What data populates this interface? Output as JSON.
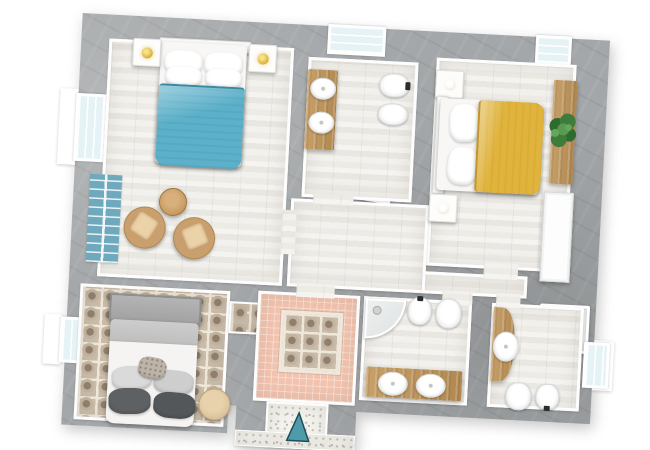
{
  "scene": {
    "type": "apartment-floor-plan-3d-top-view",
    "rotation_deg": 3,
    "visible_text": "none"
  },
  "colors": {
    "outside": "#ffffff",
    "wall": "#a4a7a9",
    "floor-plank": "#efede8",
    "plank-line": "#e9e7e1",
    "tile-pink": "#f2c3ae",
    "tile-cream": "#efe8da",
    "tile-rosette": "#8f7f6c",
    "speckle": "#f4f3ee",
    "speckle-dot": "#c6c2b7",
    "wood": "#c8a06a",
    "wood-dark": "#b08850",
    "teal-bed": "#5cb0c9",
    "yellow-bed": "#e0b33c",
    "gray-bed": "#b5b5b5",
    "window-glass": "#e6f3f6",
    "arrow-teal": "#4e9cab",
    "plant-green": "#3f7c3c",
    "lamp-gold": "#d9ae35",
    "rug-teal": "#6fa9bd",
    "rattan": "#c99f6d"
  },
  "rooms": [
    {
      "id": "bedroom-teal",
      "name": "bedroom with teal double bed and sitting area",
      "items": [
        "double-bed-teal",
        "nightstand-lamp-left",
        "nightstand-lamp-right",
        "teal-runner-rug",
        "round-wood-table",
        "wicker-chair-1",
        "wicker-chair-2"
      ]
    },
    {
      "id": "bathroom-top",
      "name": "bathroom with double-sink vanity, toilet, bidet and shower",
      "items": [
        "wood-vanity-two-sinks",
        "toilet",
        "bidet",
        "shower-tray"
      ]
    },
    {
      "id": "bedroom-yellow",
      "name": "bedroom with yellow double bed, plant console and wardrobe",
      "items": [
        "double-bed-yellow",
        "nightstand-lamp-top",
        "nightstand-lamp-bottom",
        "wood-console-with-plant",
        "white-wardrobe"
      ]
    },
    {
      "id": "hallway",
      "name": "central hallway with wood plank floor",
      "items": []
    },
    {
      "id": "bedroom-gray",
      "name": "bedroom with gray upholstered bed on decorative encaustic tile floor",
      "items": [
        "double-bed-gray",
        "decorative-pillows",
        "round-pouf"
      ]
    },
    {
      "id": "hall-pink",
      "name": "pink tiled hall with decorative tile inset",
      "items": [
        "decorative-tile-inset"
      ]
    },
    {
      "id": "entry",
      "name": "entrance with terrazzo floor and direction arrow",
      "items": [
        "entrance-arrow"
      ]
    },
    {
      "id": "bathroom-left",
      "name": "bathroom with corner shower, bidet, toilet and double-sink vanity",
      "items": [
        "corner-shower",
        "bidet",
        "toilet",
        "wood-vanity-two-sinks"
      ]
    },
    {
      "id": "bathroom-right",
      "name": "bathroom with curved vanity, shower, toilet and bidet",
      "items": [
        "curved-wood-vanity-sink",
        "shower-tray",
        "toilet",
        "bidet"
      ]
    }
  ],
  "windows": [
    {
      "id": "window-top-bathroom"
    },
    {
      "id": "window-top-bedroom-yellow"
    },
    {
      "id": "window-left-bedroom-teal"
    },
    {
      "id": "window-left-bedroom-gray"
    },
    {
      "id": "window-right-bathroom"
    }
  ],
  "icons": [
    {
      "name": "entrance-arrow-icon",
      "meaning": "entry direction pointing into the apartment"
    }
  ]
}
